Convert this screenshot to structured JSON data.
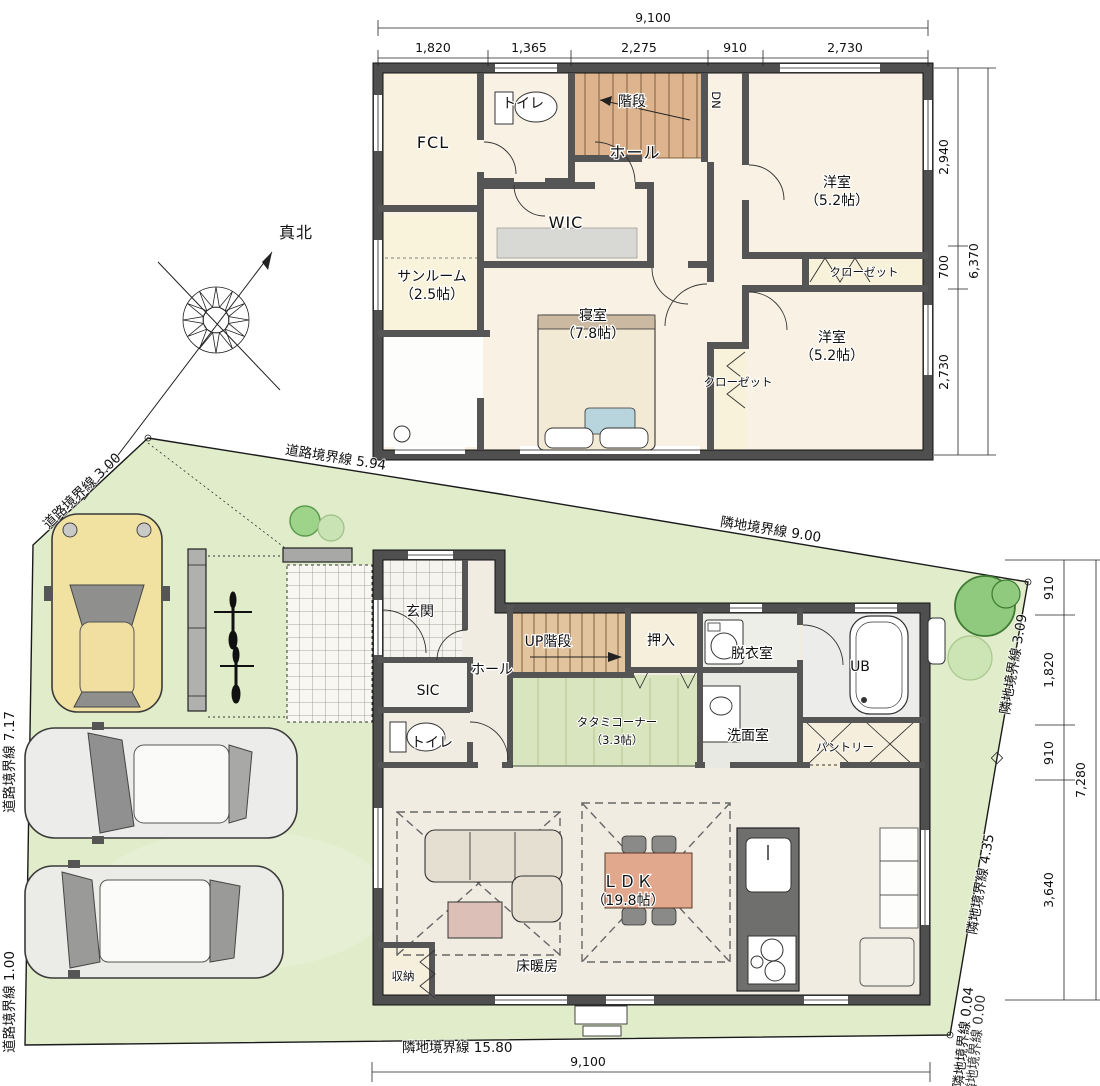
{
  "compass": {
    "north_label": "真北"
  },
  "floor2": {
    "labels": {
      "toilet": "トイレ",
      "stairs": "階段",
      "down": "DN",
      "fcl": "FCL",
      "hall": "ホール",
      "wic": "WIC",
      "sunroom": "サンルーム",
      "sunroom_size": "（2.5帖）",
      "bedroom": "寝室",
      "bedroom_size": "（7.8帖）",
      "western_room": "洋室",
      "western_room_size": "（5.2帖）",
      "closet": "クローゼット"
    },
    "dims": {
      "total_width": "9,100",
      "top": [
        "1,820",
        "1,365",
        "2,275",
        "910",
        "2,730"
      ],
      "right": [
        "2,940",
        "700",
        "2,730"
      ],
      "right_total": "6,370"
    }
  },
  "floor1": {
    "labels": {
      "entrance": "玄関",
      "hall": "ホール",
      "sic": "SIC",
      "toilet": "トイレ",
      "stairs_up": "UP階段",
      "oshiire": "押入",
      "dressing": "脱衣室",
      "bath": "UB",
      "tatami": "タタミコーナー",
      "tatami_size": "（3.3帖）",
      "washroom": "洗面室",
      "pantry": "パントリー",
      "ldk": "ＬＤＫ",
      "ldk_size": "（19.8帖）",
      "storage": "収納",
      "floor_heating": "床暖房"
    },
    "dims": {
      "right": [
        "910",
        "1,820",
        "910",
        "3,640"
      ],
      "right_total": "7,280",
      "bottom_total": "9,100"
    }
  },
  "site": {
    "boundaries": {
      "road_300": "道路境界線 3.00",
      "road_594": "道路境界線 5.94",
      "adj_900": "隣地境界線 9.00",
      "adj_309": "隣地境界線 3.09",
      "adj_435": "隣地境界線 4.35",
      "adj_004": "隣地境界線 0.04",
      "adj_000": "隣地境界線 0.00",
      "adj_1580": "隣地境界線 15.80",
      "road_717": "道路境界線 7.17",
      "road_100": "道路境界線 1.00"
    }
  },
  "colors": {
    "site_green": "#e0ecca",
    "wall": "#4f4f4f",
    "stair_wood": "#ddb48e",
    "tatami_green": "#d9e5bf",
    "car_yellow": "#f2e2a2",
    "tree_green": "#8fca7e",
    "table_wood": "#e2a88d"
  }
}
